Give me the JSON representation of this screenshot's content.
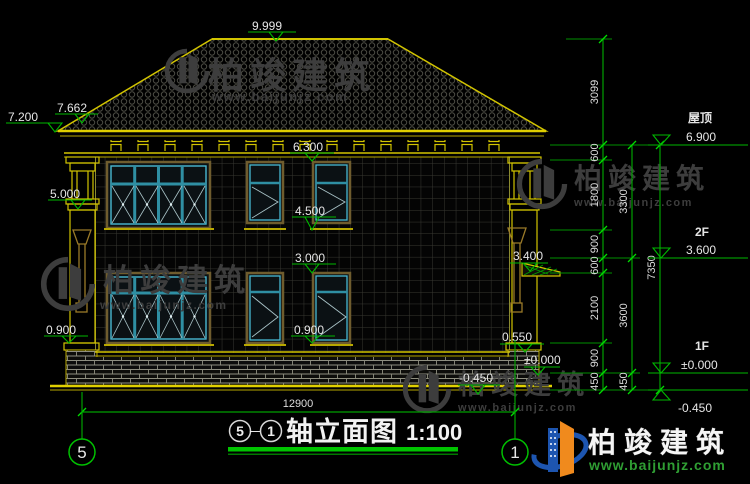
{
  "watermark": {
    "name": "柏竣建筑",
    "site": "www.baijunjz.com"
  },
  "brand": {
    "name": "柏竣建筑",
    "site": "www.baijunjz.com"
  },
  "levels": {
    "ridge": "9.999",
    "roof_upper": "7.662",
    "roof_eave": "7.200",
    "soffit": "6.300",
    "column_band": "5.000",
    "f2_sill": "4.500",
    "f1_head": "3.000",
    "awning": "3.400",
    "f1_sill_left": "0.900",
    "f1_sill_mid": "0.900",
    "plinth": "0.550",
    "zero_near": "±0.000",
    "ground_near": "-0.450"
  },
  "right_panel": {
    "roof_label": "屋顶",
    "roof_level": "6.900",
    "f2_label": "2F",
    "f2_level": "3.600",
    "f1_label": "1F",
    "f1_level": "±0.000",
    "ground_level": "-0.450",
    "chain_inner": [
      "3099",
      "600",
      "1800",
      "900",
      "600",
      "2100",
      "900",
      "450"
    ],
    "chain_mid": [
      "3300",
      "3600",
      "450"
    ],
    "chain_outer": [
      "7350"
    ]
  },
  "bottom": {
    "width_dim": "12900",
    "axis_left": "5",
    "axis_right": "1",
    "title": {
      "axis_a": "5",
      "dash": "－",
      "axis_b": "1",
      "text": "轴立面图",
      "scale": "1:100"
    }
  }
}
